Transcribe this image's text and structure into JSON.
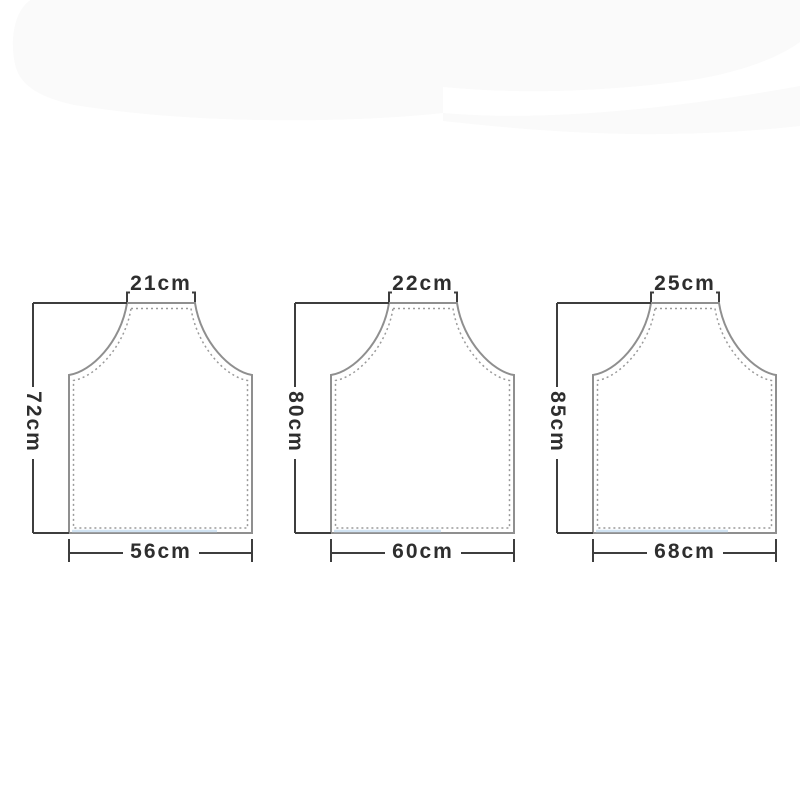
{
  "diagram_type": "apron-size-chart",
  "unit": "cm",
  "aprons": [
    {
      "id": "size-1",
      "top_width": "21cm",
      "height": "72cm",
      "bottom_width": "56cm",
      "top_width_cm": 21,
      "height_cm": 72,
      "bottom_width_cm": 56
    },
    {
      "id": "size-2",
      "top_width": "22cm",
      "height": "80cm",
      "bottom_width": "60cm",
      "top_width_cm": 22,
      "height_cm": 80,
      "bottom_width_cm": 60
    },
    {
      "id": "size-3",
      "top_width": "25cm",
      "height": "85cm",
      "bottom_width": "68cm",
      "top_width_cm": 25,
      "height_cm": 85,
      "bottom_width_cm": 68
    }
  ],
  "colors": {
    "background": "#ffffff",
    "outline_gray": "#8f8f8f",
    "stitch_gray": "#9a9a9a",
    "dimension_dark": "#3d3d3d",
    "label_text": "#2e2e2e",
    "highlight_blue": "#c9def0",
    "artifact_gray": "#fafafa"
  }
}
